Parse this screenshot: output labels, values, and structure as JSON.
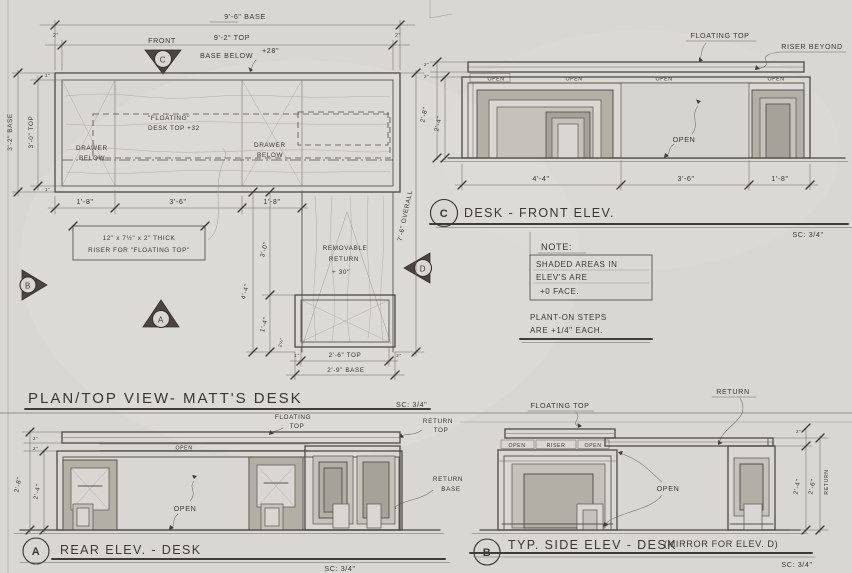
{
  "plan": {
    "title": "PLAN/TOP VIEW- MATT'S DESK",
    "scale": "SC: 3/4\"",
    "front_label": "FRONT",
    "front_letter": "C",
    "marker_a": "A",
    "marker_b": "B",
    "marker_d": "D",
    "dim_base_width": "9'-6\" BASE",
    "dim_top_width": "9'-2\" TOP",
    "dim_end_left": "2\"",
    "dim_end_right": "2\"",
    "dim_base_depth": "3'-2\" BASE",
    "dim_top_depth": "3'-0\" TOP",
    "dim_side_small_top": "1\"",
    "dim_side_small_bot": "1\"",
    "base_below": "BASE BELOW",
    "base_below_height": "+28\"",
    "floating_1": "\"FLOATING\"",
    "floating_2": "DESK TOP +32",
    "drawer1_1": "DRAWER",
    "drawer1_2": "BELOW",
    "drawer2_1": "DRAWER",
    "drawer2_2": "BELOW",
    "dim_bay_1": "1'-8\"",
    "dim_bay_2": "3'-6\"",
    "dim_bay_3": "1'-8\"",
    "riser_1": "12\" x 7½\" x 2\" THICK",
    "riser_2": "RISER FOR \"FLOATING TOP\"",
    "return_1": "REMOVABLE",
    "return_2": "RETURN",
    "return_3": "+ 30\"",
    "dim_return_ext": "4'-4\"",
    "dim_return_gap": "3'-0\"",
    "dim_return_depth": "1'-4\"",
    "dim_return_small": "2¼\"",
    "dim_return_small_l": "1\"",
    "dim_return_small_r": "2\"",
    "dim_return_top_w": "2'-6\" TOP",
    "dim_return_base_w": "2'-9\" BASE",
    "dim_overall": "7'-6\" OVERALL"
  },
  "front_elev": {
    "marker": "C",
    "title": "DESK - FRONT ELEV.",
    "scale": "SC: 3/4\"",
    "floating_top": "FLOATING TOP",
    "riser_beyond": "RISER BEYOND",
    "open_labels": [
      "OPEN",
      "OPEN",
      "OPEN",
      "OPEN"
    ],
    "open_center": "OPEN",
    "dim_bay_1": "4'-4\"",
    "dim_bay_2": "3'-6\"",
    "dim_bay_3": "1'-8\"",
    "dim_height_overall": "2'-8\"",
    "dim_height_body": "2'-4\"",
    "dim_top_thk": "2\"",
    "dim_gap": "2\""
  },
  "notes": {
    "heading": "NOTE:",
    "body_1": "SHADED AREAS IN",
    "body_2": "ELEV'S ARE",
    "body_3": "+0 FACE.",
    "foot_1": "PLANT-ON STEPS",
    "foot_2": "ARE +1/4\" EACH."
  },
  "rear_elev": {
    "marker": "A",
    "title": "REAR ELEV. - DESK",
    "scale": "SC: 3/4\"",
    "floating_1": "FLOATING",
    "floating_2": "TOP",
    "return_top_1": "RETURN",
    "return_top_2": "TOP",
    "open_strip": "OPEN",
    "open_center": "OPEN",
    "return_base_1": "RETURN",
    "return_base_2": "BASE",
    "dim_height_overall": "2'-8\"",
    "dim_height_body": "2'-4\"",
    "dim_top_thk": "2\"",
    "dim_gap": "2\""
  },
  "side_elev": {
    "marker": "B",
    "title": "TYP. SIDE ELEV - DESK",
    "title_suffix": "(MIRROR FOR ELEV. D)",
    "scale": "SC: 3/4\"",
    "floating_top": "FLOATING TOP",
    "return_label": "RETURN",
    "strip_1": "OPEN",
    "strip_2": "RISER",
    "strip_3": "OPEN",
    "open_center": "OPEN",
    "dim_body": "2'-4\"",
    "dim_return": "2'-6\"",
    "dim_return_word": "RETURN",
    "dim_top_thk": "2\""
  }
}
